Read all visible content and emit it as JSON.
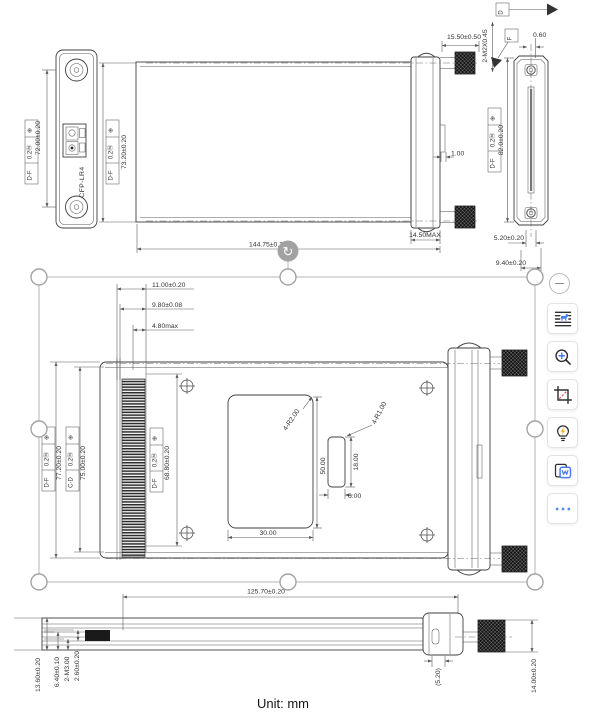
{
  "unit_label": "Unit: mm",
  "module_label": "CFP-LR4",
  "gdt": {
    "position_symbol": "⊕",
    "tolerance_m": "0.2Ⓜ",
    "datum_df": "D-F",
    "datum_cd": "C-D",
    "datum_d": "D",
    "datum_f": "F"
  },
  "dims": {
    "front_height": "72.00±0.20",
    "top_height": "73.20±0.20",
    "overall_length": "144.75±0.2",
    "screw_length": "15.50±0.50",
    "screw_thread": "2-M2X0.45",
    "offset_060": "0.60",
    "slot_100": "1.00",
    "bezel_max": "14.50MAX",
    "end_height": "82.0±0.20",
    "end_520": "5.20±0.20",
    "end_940": "9.40±0.20",
    "plan_1100": "11.00±0.20",
    "plan_980": "9.80±0.08",
    "plan_480": "4.80max",
    "plan_7720": "77.20±0.20",
    "plan_7500": "75.00±0.20",
    "plan_6880": "68.80±0.20",
    "plan_r2": "4-R2.00",
    "plan_r1": "4-R1.00",
    "plan_5000": "50.00",
    "plan_3000": "30.00",
    "plan_1800": "18.00",
    "plan_600": "6.00",
    "bottom_length": "125.70±0.20",
    "bottom_1360": "13.60±0.20",
    "bottom_640": "6.40±0.10",
    "bottom_m3": "2-M3.00",
    "bottom_260": "2.60±0.20",
    "bottom_520": "(5.20)",
    "bottom_1400": "14.00±0.20"
  },
  "overlay": {
    "rotate_glyph": "↻"
  },
  "toolbar": {
    "buttons": [
      {
        "name": "ocr-document"
      },
      {
        "name": "zoom-in"
      },
      {
        "name": "crop"
      },
      {
        "name": "smart-suggest"
      },
      {
        "name": "export-word"
      },
      {
        "name": "more"
      }
    ]
  }
}
